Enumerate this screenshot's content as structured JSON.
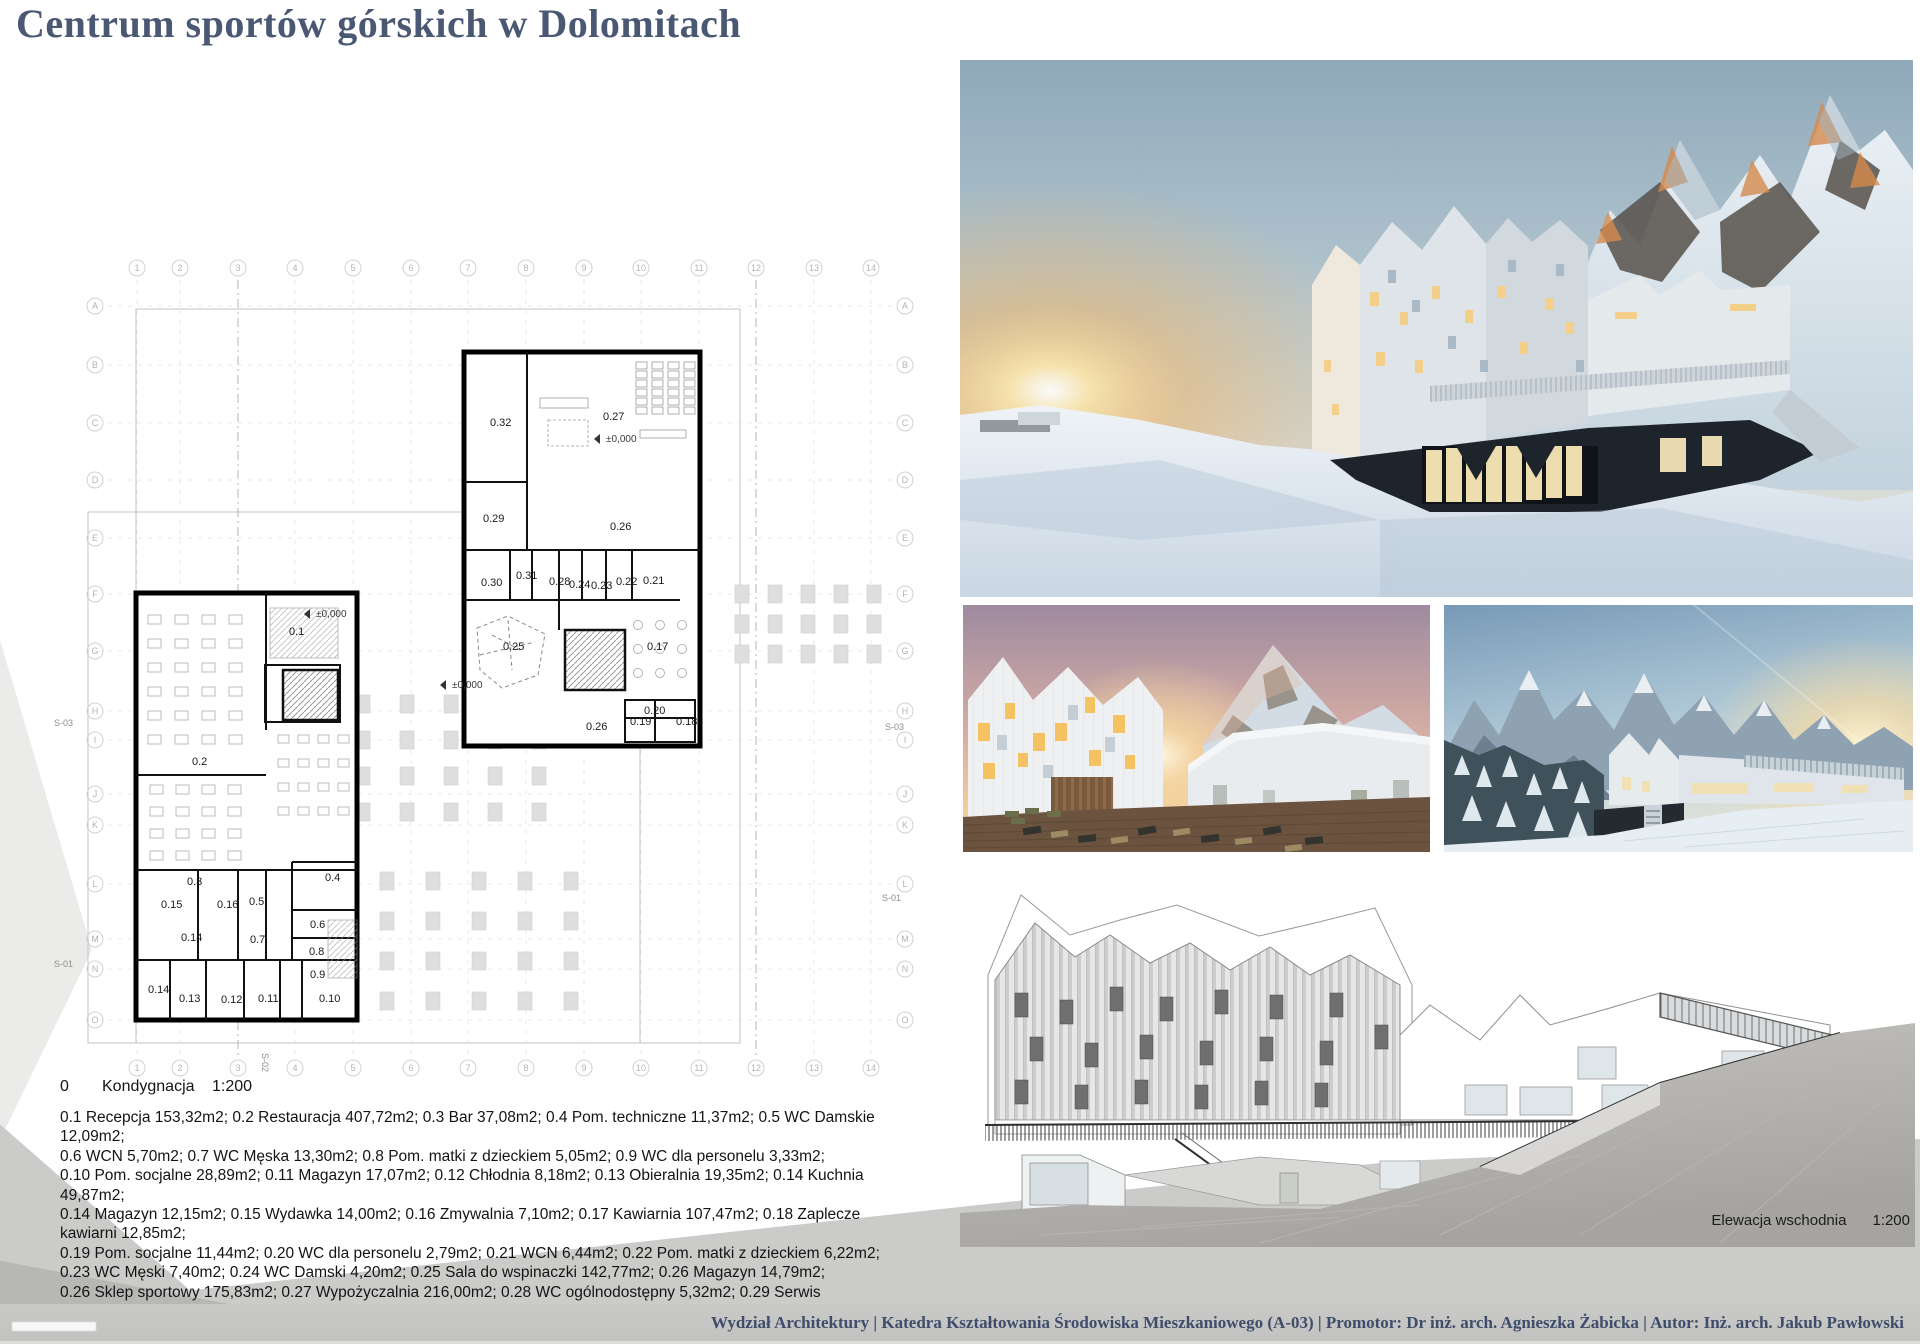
{
  "poster": {
    "title": "Centrum sportów górskich w Dolomitach"
  },
  "plan": {
    "storey_label": "0",
    "storey_name": "Kondygnacja",
    "scale": "1:200",
    "grid": {
      "columns": [
        "1",
        "2",
        "3",
        "4",
        "5",
        "6",
        "7",
        "8",
        "9",
        "10",
        "11",
        "12",
        "13",
        "14"
      ],
      "rows": [
        "A",
        "B",
        "C",
        "D",
        "E",
        "F",
        "G",
        "H",
        "I",
        "J",
        "K",
        "L",
        "M",
        "N",
        "O"
      ]
    },
    "sections": [
      {
        "t": "S-03",
        "x": 14,
        "y": 596,
        "rot": 0
      },
      {
        "t": "S-03",
        "x": 845,
        "y": 600,
        "rot": 0
      },
      {
        "t": "S-01",
        "x": 14,
        "y": 837,
        "rot": 0
      },
      {
        "t": "S-01",
        "x": 842,
        "y": 771,
        "rot": 0
      },
      {
        "t": "S-02",
        "x": 222,
        "y": 923,
        "rot": 90
      }
    ],
    "levels": [
      {
        "t": "±0,000",
        "x": 566,
        "y": 312
      },
      {
        "t": "±0,000",
        "x": 276,
        "y": 487
      },
      {
        "t": "±0,000",
        "x": 412,
        "y": 558
      }
    ],
    "rooms": [
      {
        "t": "0.32",
        "x": 450,
        "y": 296
      },
      {
        "t": "0.27",
        "x": 563,
        "y": 290
      },
      {
        "t": "0.29",
        "x": 443,
        "y": 392
      },
      {
        "t": "0.26",
        "x": 570,
        "y": 400
      },
      {
        "t": "0.30",
        "x": 441,
        "y": 456
      },
      {
        "t": "0.31",
        "x": 476,
        "y": 449
      },
      {
        "t": "0.28",
        "x": 509,
        "y": 455
      },
      {
        "t": "0.24",
        "x": 529,
        "y": 458
      },
      {
        "t": "0.23",
        "x": 551,
        "y": 459
      },
      {
        "t": "0.22",
        "x": 576,
        "y": 455
      },
      {
        "t": "0.21",
        "x": 603,
        "y": 454
      },
      {
        "t": "0.25",
        "x": 463,
        "y": 520
      },
      {
        "t": "0.17",
        "x": 607,
        "y": 520
      },
      {
        "t": "0.20",
        "x": 604,
        "y": 584
      },
      {
        "t": "0.19",
        "x": 590,
        "y": 595
      },
      {
        "t": "0.18",
        "x": 636,
        "y": 595
      },
      {
        "t": "0.26",
        "x": 546,
        "y": 600
      },
      {
        "t": "0.1",
        "x": 249,
        "y": 505
      },
      {
        "t": "0.2",
        "x": 152,
        "y": 635
      },
      {
        "t": "0.3",
        "x": 147,
        "y": 755
      },
      {
        "t": "0.4",
        "x": 285,
        "y": 751
      },
      {
        "t": "0.15",
        "x": 121,
        "y": 778
      },
      {
        "t": "0.16",
        "x": 177,
        "y": 778
      },
      {
        "t": "0.5",
        "x": 209,
        "y": 775
      },
      {
        "t": "0.6",
        "x": 270,
        "y": 798
      },
      {
        "t": "0.14",
        "x": 141,
        "y": 811
      },
      {
        "t": "0.7",
        "x": 210,
        "y": 813
      },
      {
        "t": "0.8",
        "x": 269,
        "y": 825
      },
      {
        "t": "0.9",
        "x": 270,
        "y": 848
      },
      {
        "t": "0.14",
        "x": 108,
        "y": 863
      },
      {
        "t": "0.13",
        "x": 139,
        "y": 872
      },
      {
        "t": "0.12",
        "x": 181,
        "y": 873
      },
      {
        "t": "0.11",
        "x": 218,
        "y": 872
      },
      {
        "t": "0.10",
        "x": 279,
        "y": 872
      }
    ]
  },
  "legend": {
    "lines": [
      "0.1 Recepcja 153,32m2; 0.2 Restauracja 407,72m2; 0.3 Bar 37,08m2; 0.4 Pom. techniczne 11,37m2; 0.5 WC Damskie 12,09m2;",
      "0.6 WCN 5,70m2; 0.7 WC Męska 13,30m2; 0.8 Pom. matki z dzieckiem 5,05m2; 0.9 WC dla personelu 3,33m2;",
      "0.10 Pom. socjalne 28,89m2; 0.11 Magazyn 17,07m2; 0.12 Chłodnia 8,18m2; 0.13 Obieralnia 19,35m2; 0.14 Kuchnia 49,87m2;",
      "0.14 Magazyn 12,15m2; 0.15 Wydawka 14,00m2; 0.16 Zmywalnia 7,10m2; 0.17 Kawiarnia 107,47m2; 0.18 Zaplecze kawiarni 12,85m2;",
      "0.19 Pom. socjalne 11,44m2; 0.20 WC dla personelu 2,79m2; 0.21 WCN 6,44m2; 0.22 Pom. matki z dzieckiem 6,22m2;",
      "0.23 WC Męski 7,40m2; 0.24 WC Damski 4,20m2; 0.25 Sala do wspinaczki 142,77m2; 0.26 Magazyn 14,79m2;",
      "0.26 Sklep sportowy 175,83m2; 0.27 Wypożyczalnia 216,00m2; 0.28 WC ogólnodostępny 5,32m2; 0.29 Serwis 32,60m2;",
      "0.30 Pom. socjalne 12,40m2; 0.31 WC dla personelu 3,42m2; 0.32 Magazyn 80,53m2",
      "Razem:1 648,04 m2"
    ]
  },
  "elevation": {
    "label": "Elewacja wschodnia",
    "scale": "1:200"
  },
  "footer": {
    "credits": "Wydział Architektury | Katedra Kształtowania Środowiska Mieszkaniowego (A-03) | Promotor: Dr inż. arch. Agnieszka Żabicka | Autor: Inż. arch. Jakub Pawłowski"
  },
  "colors": {
    "title_text": "#4a5874",
    "footer_text": "#3e4d6b",
    "sky_blue": "#93adbd",
    "sunset_orange": "#f0a64f",
    "dark_base": "#20262e",
    "plan_wall": "#000000"
  }
}
